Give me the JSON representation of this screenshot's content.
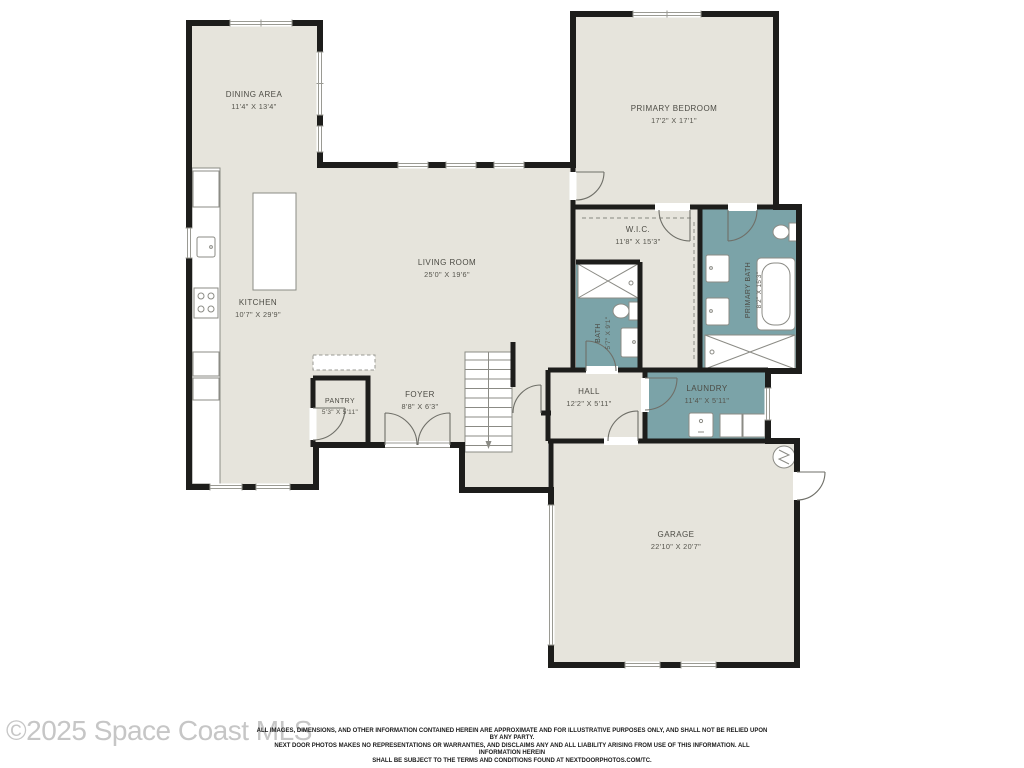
{
  "colors": {
    "background": "#ffffff",
    "wall": "#1d1d1b",
    "floor": "#e6e4dc",
    "wet": "#7ba3a8",
    "fixture_stroke": "#8b8b85",
    "label": "#4c4b44",
    "watermark": "#c6c6c6",
    "disclaimer": "#1a1a1a"
  },
  "watermark": "©2025 Space Coast MLS",
  "disclaimer": {
    "line1": "ALL IMAGES, DIMENSIONS, AND OTHER INFORMATION CONTAINED HEREIN ARE APPROXIMATE AND FOR ILLUSTRATIVE PURPOSES ONLY, AND SHALL NOT BE RELIED UPON BY ANY PARTY.",
    "line2": "NEXT DOOR PHOTOS MAKES NO REPRESENTATIONS OR WARRANTIES, AND DISCLAIMS ANY AND ALL LIABILITY ARISING FROM USE OF THIS INFORMATION. ALL INFORMATION HEREIN",
    "line3": "SHALL BE SUBJECT TO THE TERMS AND CONDITIONS FOUND AT NEXTDOORPHOTOS.COM/TC."
  },
  "rooms": {
    "dining": {
      "name": "DINING AREA",
      "dims": "11'4\" X 13'4\""
    },
    "kitchen": {
      "name": "KITCHEN",
      "dims": "10'7\" X 29'9\""
    },
    "living": {
      "name": "LIVING ROOM",
      "dims": "25'0\" X 19'6\""
    },
    "pantry": {
      "name": "PANTRY",
      "dims": "5'3\" X 5'11\""
    },
    "foyer": {
      "name": "FOYER",
      "dims": "8'8\" X 6'3\""
    },
    "hall": {
      "name": "HALL",
      "dims": "12'2\" X 5'11\""
    },
    "wic": {
      "name": "W.I.C.",
      "dims": "11'8\" X 15'3\""
    },
    "primary_bedroom": {
      "name": "PRIMARY BEDROOM",
      "dims": "17'2\" X 17'1\""
    },
    "primary_bath": {
      "name": "PRIMARY BATH",
      "dims": "8'2\" X 15'3\""
    },
    "bath": {
      "name": "BATH",
      "dims": "5'7\" X 9'1\""
    },
    "laundry": {
      "name": "LAUNDRY",
      "dims": "11'4\" X 5'11\""
    },
    "garage": {
      "name": "GARAGE",
      "dims": "22'10\" X 20'7\""
    }
  }
}
